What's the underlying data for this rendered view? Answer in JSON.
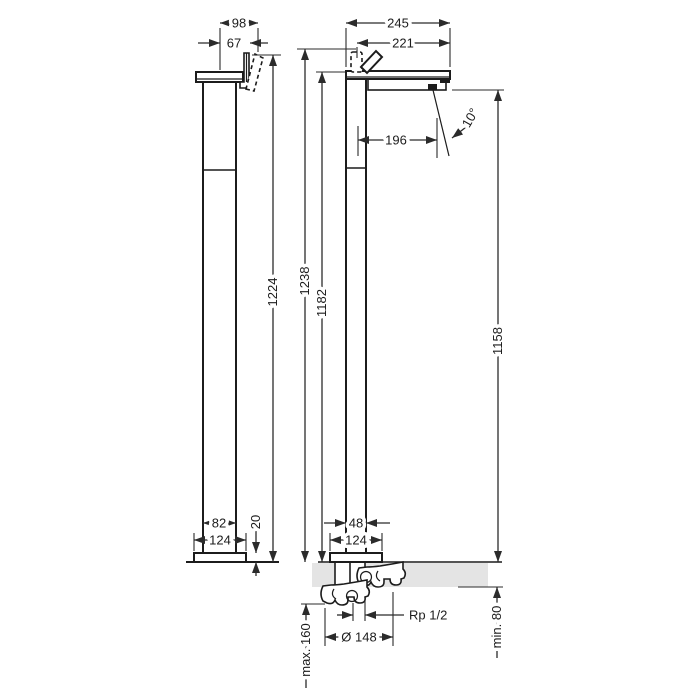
{
  "drawing": {
    "kind": "technical dimension drawing",
    "subject": "floor-standing single-lever mixer tap, two orthographic views with installation detail"
  },
  "dims": {
    "side": {
      "top_depth": "98",
      "spout_depth": "67",
      "height_overall": "1224",
      "column_depth": "82",
      "base_depth": "124",
      "base_height": "20"
    },
    "front": {
      "spout_reach": "245",
      "handle_to_spout": "221",
      "aerator_offset": "196",
      "spray_angle": "10°",
      "height_max": "1238",
      "height_spout_top": "1182",
      "height_spout_underside": "1158",
      "column_width": "48",
      "base_width": "124"
    },
    "install": {
      "hole_diameter": "Ø 148",
      "thread": "Rp 1/2",
      "below_floor_max": "max. 160",
      "floor_min": "min. 80"
    }
  },
  "colors": {
    "line": "#1c1c1c",
    "dim_line": "#2b2b2b",
    "floor_fill": "#e4e4e4",
    "background": "#ffffff"
  }
}
